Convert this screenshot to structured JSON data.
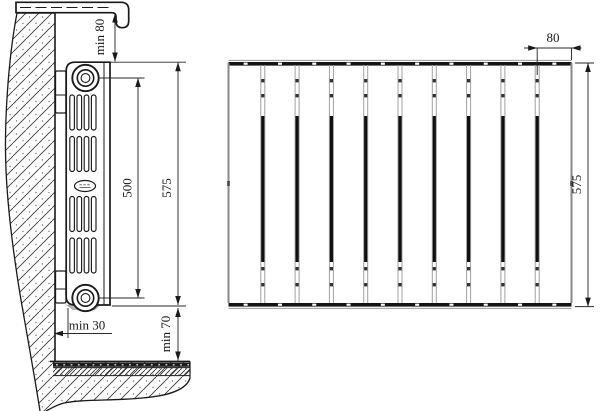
{
  "meta": {
    "type": "technical-drawing",
    "subject": "sectional radiator installation dimensions",
    "background_color": "#ffffff",
    "line_color": "#1a1a1a",
    "gray_line_color": "#9a9a9a"
  },
  "side_view": {
    "labels": {
      "top_clearance": "min 80",
      "axis_spacing": "500",
      "radiator_height": "575",
      "wall_clearance": "min 30",
      "floor_clearance": "min 70"
    },
    "features": [
      "window-sill with dashed centerline",
      "hatched concrete wall",
      "two wall brackets",
      "top and bottom nipple bosses",
      "four fin groups",
      "oval brand badge",
      "layered floor: finish, screed, concrete"
    ]
  },
  "front_view": {
    "section_count": 10,
    "labels": {
      "section_width": "80",
      "radiator_height": "575"
    }
  }
}
